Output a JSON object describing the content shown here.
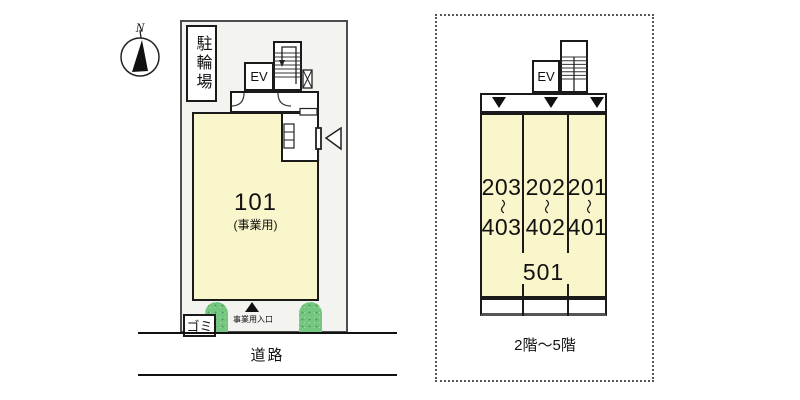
{
  "diagram": {
    "compass_label": "N",
    "floor1": {
      "bicycle_parking": "駐輪場",
      "elevator": "EV",
      "unit_number": "101",
      "unit_use": "(事業用)",
      "garbage": "ゴミ",
      "entrance": "事業用入口",
      "road": "道路"
    },
    "upper_floors": {
      "elevator": "EV",
      "unit_stacks": [
        {
          "top": "203",
          "tilde": "〜",
          "bottom": "403"
        },
        {
          "top": "202",
          "tilde": "〜",
          "bottom": "402"
        },
        {
          "top": "201",
          "tilde": "〜",
          "bottom": "401"
        }
      ],
      "fifth_floor_unit": "501",
      "floors_label": "2階〜5階"
    },
    "colors": {
      "room_fill": "#FAF6CC",
      "site_fill": "#F3F3F0",
      "shrub_green": "#74C680",
      "outline": "#1A1A1A"
    }
  }
}
